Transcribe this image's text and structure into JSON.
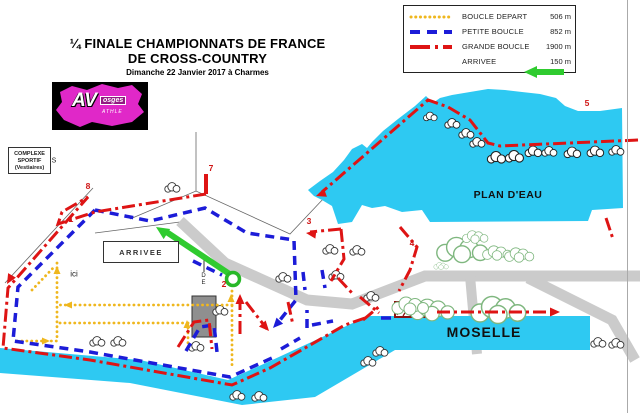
{
  "title": {
    "line1": "¼ FINALE CHAMPIONNATS DE FRANCE",
    "line2": "DE CROSS-COUNTRY",
    "line3": "Dimanche 22 Janvier 2017 à Charmes"
  },
  "logo": {
    "big": "AV",
    "box": "osges",
    "sub": "ATHLE"
  },
  "legend": {
    "rows": [
      {
        "label": "BOUCLE  DEPART",
        "distance": "506 m"
      },
      {
        "label": "PETITE  BOUCLE",
        "distance": "852 m"
      },
      {
        "label": "GRANDE BOUCLE",
        "distance": "1900 m"
      },
      {
        "label": "ARRIVEE",
        "distance": "150 m"
      }
    ]
  },
  "map_labels": {
    "plan_deau": "PLAN D'EAU",
    "moselle": "MOSELLE",
    "arrivee": "ARRIVEE",
    "complexe": [
      "COMPLEXE",
      "SPORTIF",
      "(Vestiaires)"
    ],
    "ici": "ici",
    "s": "S",
    "d": "D",
    "e": "E"
  },
  "checkpoints": [
    {
      "n": "1"
    },
    {
      "n": "2"
    },
    {
      "n": "3"
    },
    {
      "n": "4"
    },
    {
      "n": "5"
    },
    {
      "n": "7"
    },
    {
      "n": "8"
    }
  ],
  "colors": {
    "water": "#2EC9F2",
    "boucle_depart": "#EFB71E",
    "petite_boucle": "#1C1CD8",
    "grande_boucle": "#DE1414",
    "arrivee_arrow": "#2FCB2F",
    "road": "#CBCBCB"
  }
}
